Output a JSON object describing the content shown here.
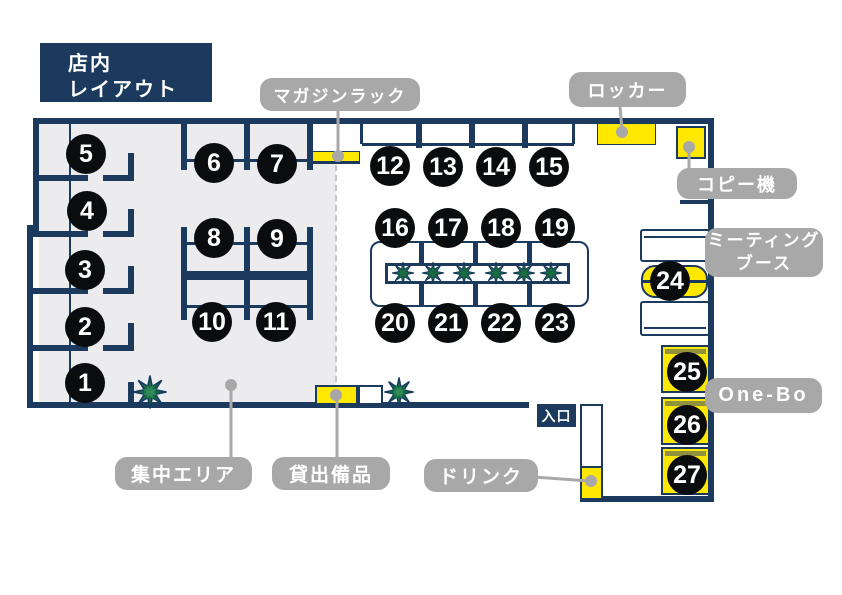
{
  "title": {
    "lines": [
      "店内",
      "レイアウト"
    ]
  },
  "seats": [
    "1",
    "2",
    "3",
    "4",
    "5",
    "6",
    "7",
    "8",
    "9",
    "10",
    "11",
    "12",
    "13",
    "14",
    "15",
    "16",
    "17",
    "18",
    "19",
    "20",
    "21",
    "22",
    "23",
    "24",
    "25",
    "26",
    "27"
  ],
  "callouts": {
    "magazine_rack": "マガジンラック",
    "locker": "ロッカー",
    "copier": "コピー機",
    "meeting_booth_lines": [
      "ミーティング",
      "ブース"
    ],
    "one_bo": "One-Bo",
    "focus_area": "集中エリア",
    "rental_equipment": "貸出備品",
    "drink": "ドリンク",
    "entrance": "入口"
  },
  "colors": {
    "wall_navy": "#1b3a5e",
    "seat_black": "#0b0c0e",
    "highlight_yellow": "#ffe800",
    "label_gray": "#a8a8a8",
    "floor_gray": "#ececee",
    "plant_green": "#1a6b3f",
    "onebo_band_olive": "#90923d",
    "dashed_divider_gray": "#c2c5c9"
  }
}
